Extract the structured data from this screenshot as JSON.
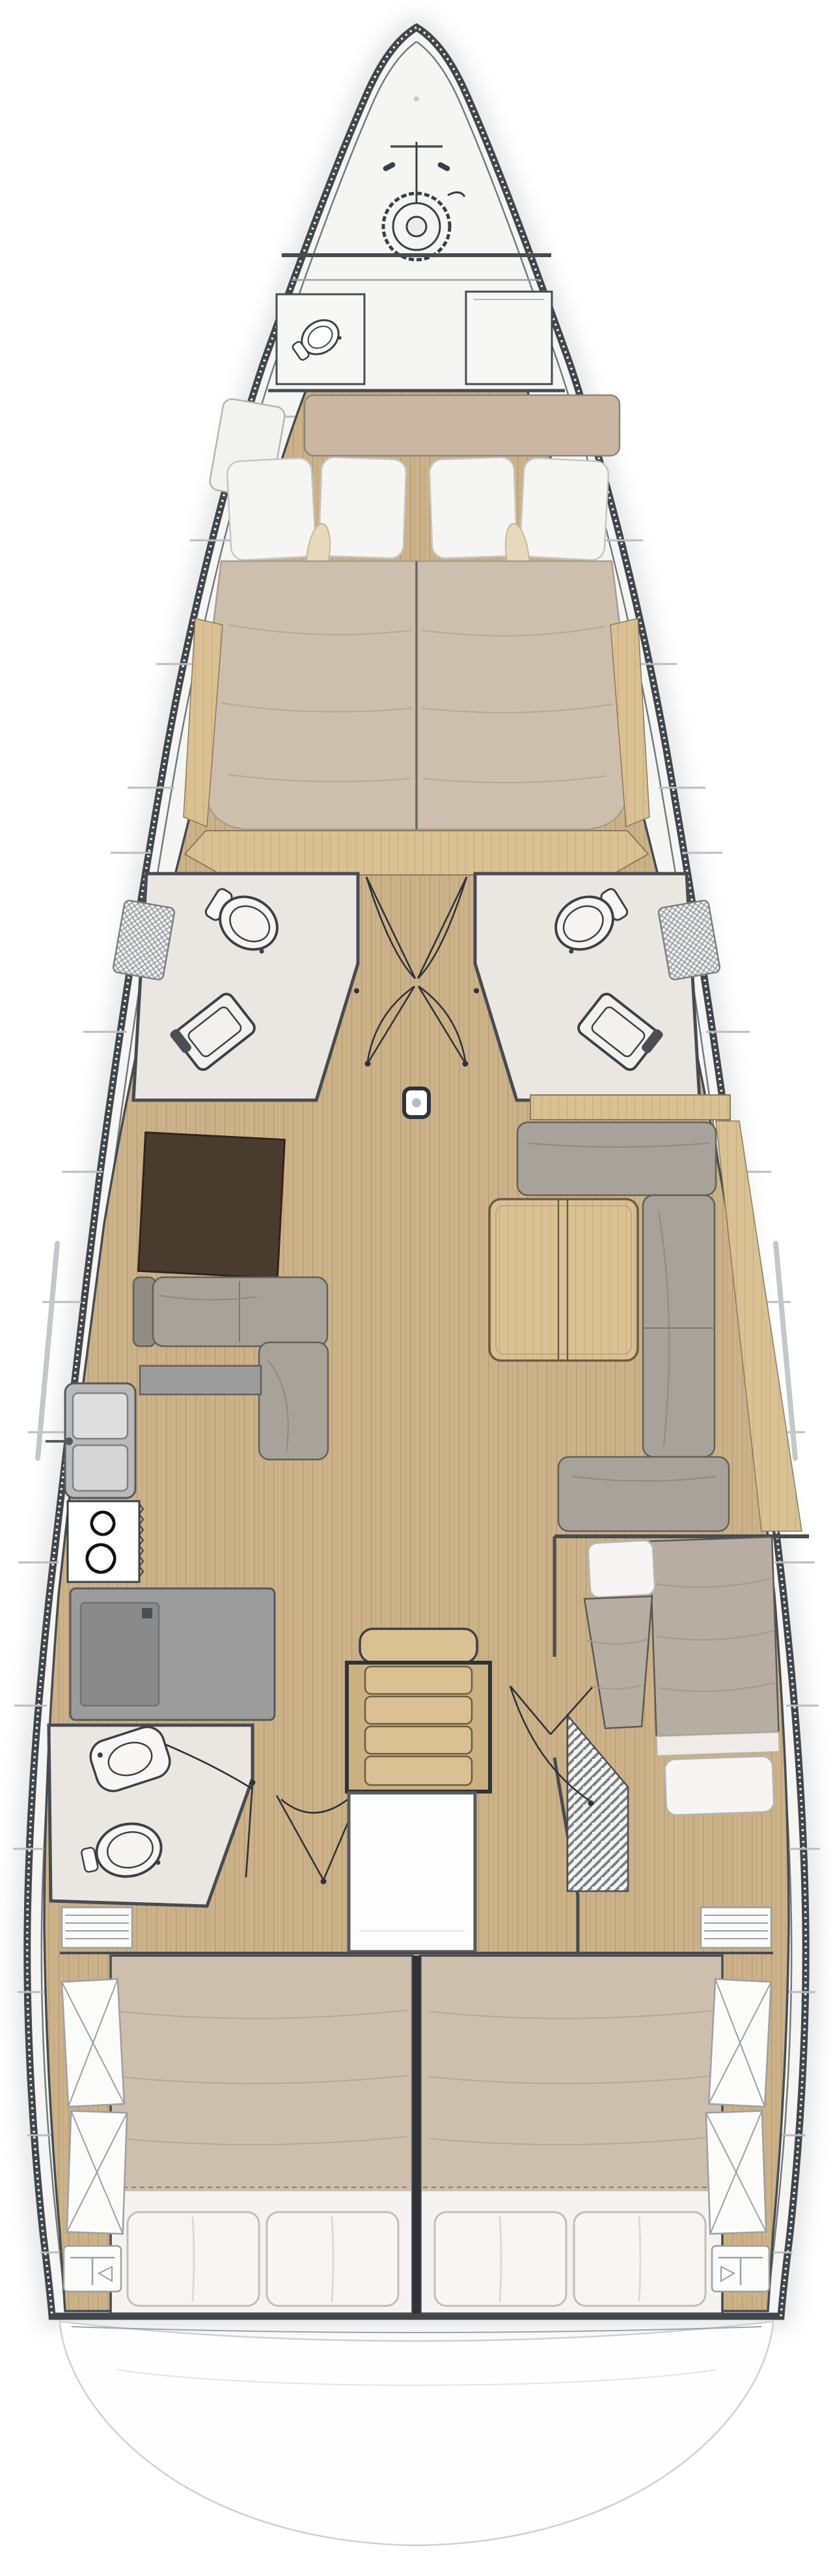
{
  "diagram": {
    "type": "boat-floor-plan",
    "view": "top-down-interior-layout",
    "orientation": "bow-top-stern-bottom"
  },
  "palette": {
    "hull": "#41464b",
    "hullInner": "#74797e",
    "deck": "#f5f5f4",
    "deckLine": "#b9bdc1",
    "floorWood": "#cbb289",
    "floorWoodLine": "#aa8f69",
    "furnWood": "#d9c193",
    "furnWoodLine": "#bfa170",
    "woodDark": "#8a7a5c",
    "sofa": "#a7a29a",
    "sofaDark": "#918c84",
    "sofaEdge": "#63605a",
    "duvetTan": "#cdbfae",
    "duvetGray": "#b6aea3",
    "linen": "#f4f3f1",
    "linenEdge": "#c3beb6",
    "accentPillow": "#e7d9bd",
    "headsFloor": "#eae7e2",
    "wall": "#474c51",
    "thin": "#2f3338",
    "cabinetDark": "#4a3b2f",
    "appliance": "#9c9c9c",
    "applianceDark": "#8a8a8a",
    "stairsWood": "#d9c193",
    "paper": "#ffffff",
    "shadow": "#c4c5c7",
    "foldTan": "#b5a898",
    "foldGray": "#a39b90"
  },
  "rooms": [
    {
      "name": "anchor-locker"
    },
    {
      "name": "crew-cabin"
    },
    {
      "name": "owner-cabin-forward"
    },
    {
      "name": "head-port-forward"
    },
    {
      "name": "head-starboard-forward"
    },
    {
      "name": "saloon"
    },
    {
      "name": "galley-port"
    },
    {
      "name": "aft-head-port"
    },
    {
      "name": "companionway"
    },
    {
      "name": "bunk-cabin-starboard"
    },
    {
      "name": "aft-cabin-port"
    },
    {
      "name": "aft-cabin-starboard"
    },
    {
      "name": "transom-swim-platform"
    }
  ],
  "icons": [
    {
      "name": "windlass-icon"
    },
    {
      "name": "toilet-icon"
    },
    {
      "name": "shower-seat-icon"
    },
    {
      "name": "sink-icon"
    },
    {
      "name": "stove-icon"
    },
    {
      "name": "mast-post-icon"
    },
    {
      "name": "door-swing-icon"
    },
    {
      "name": "locker-x-icon"
    },
    {
      "name": "louvre-locker-icon"
    }
  ]
}
